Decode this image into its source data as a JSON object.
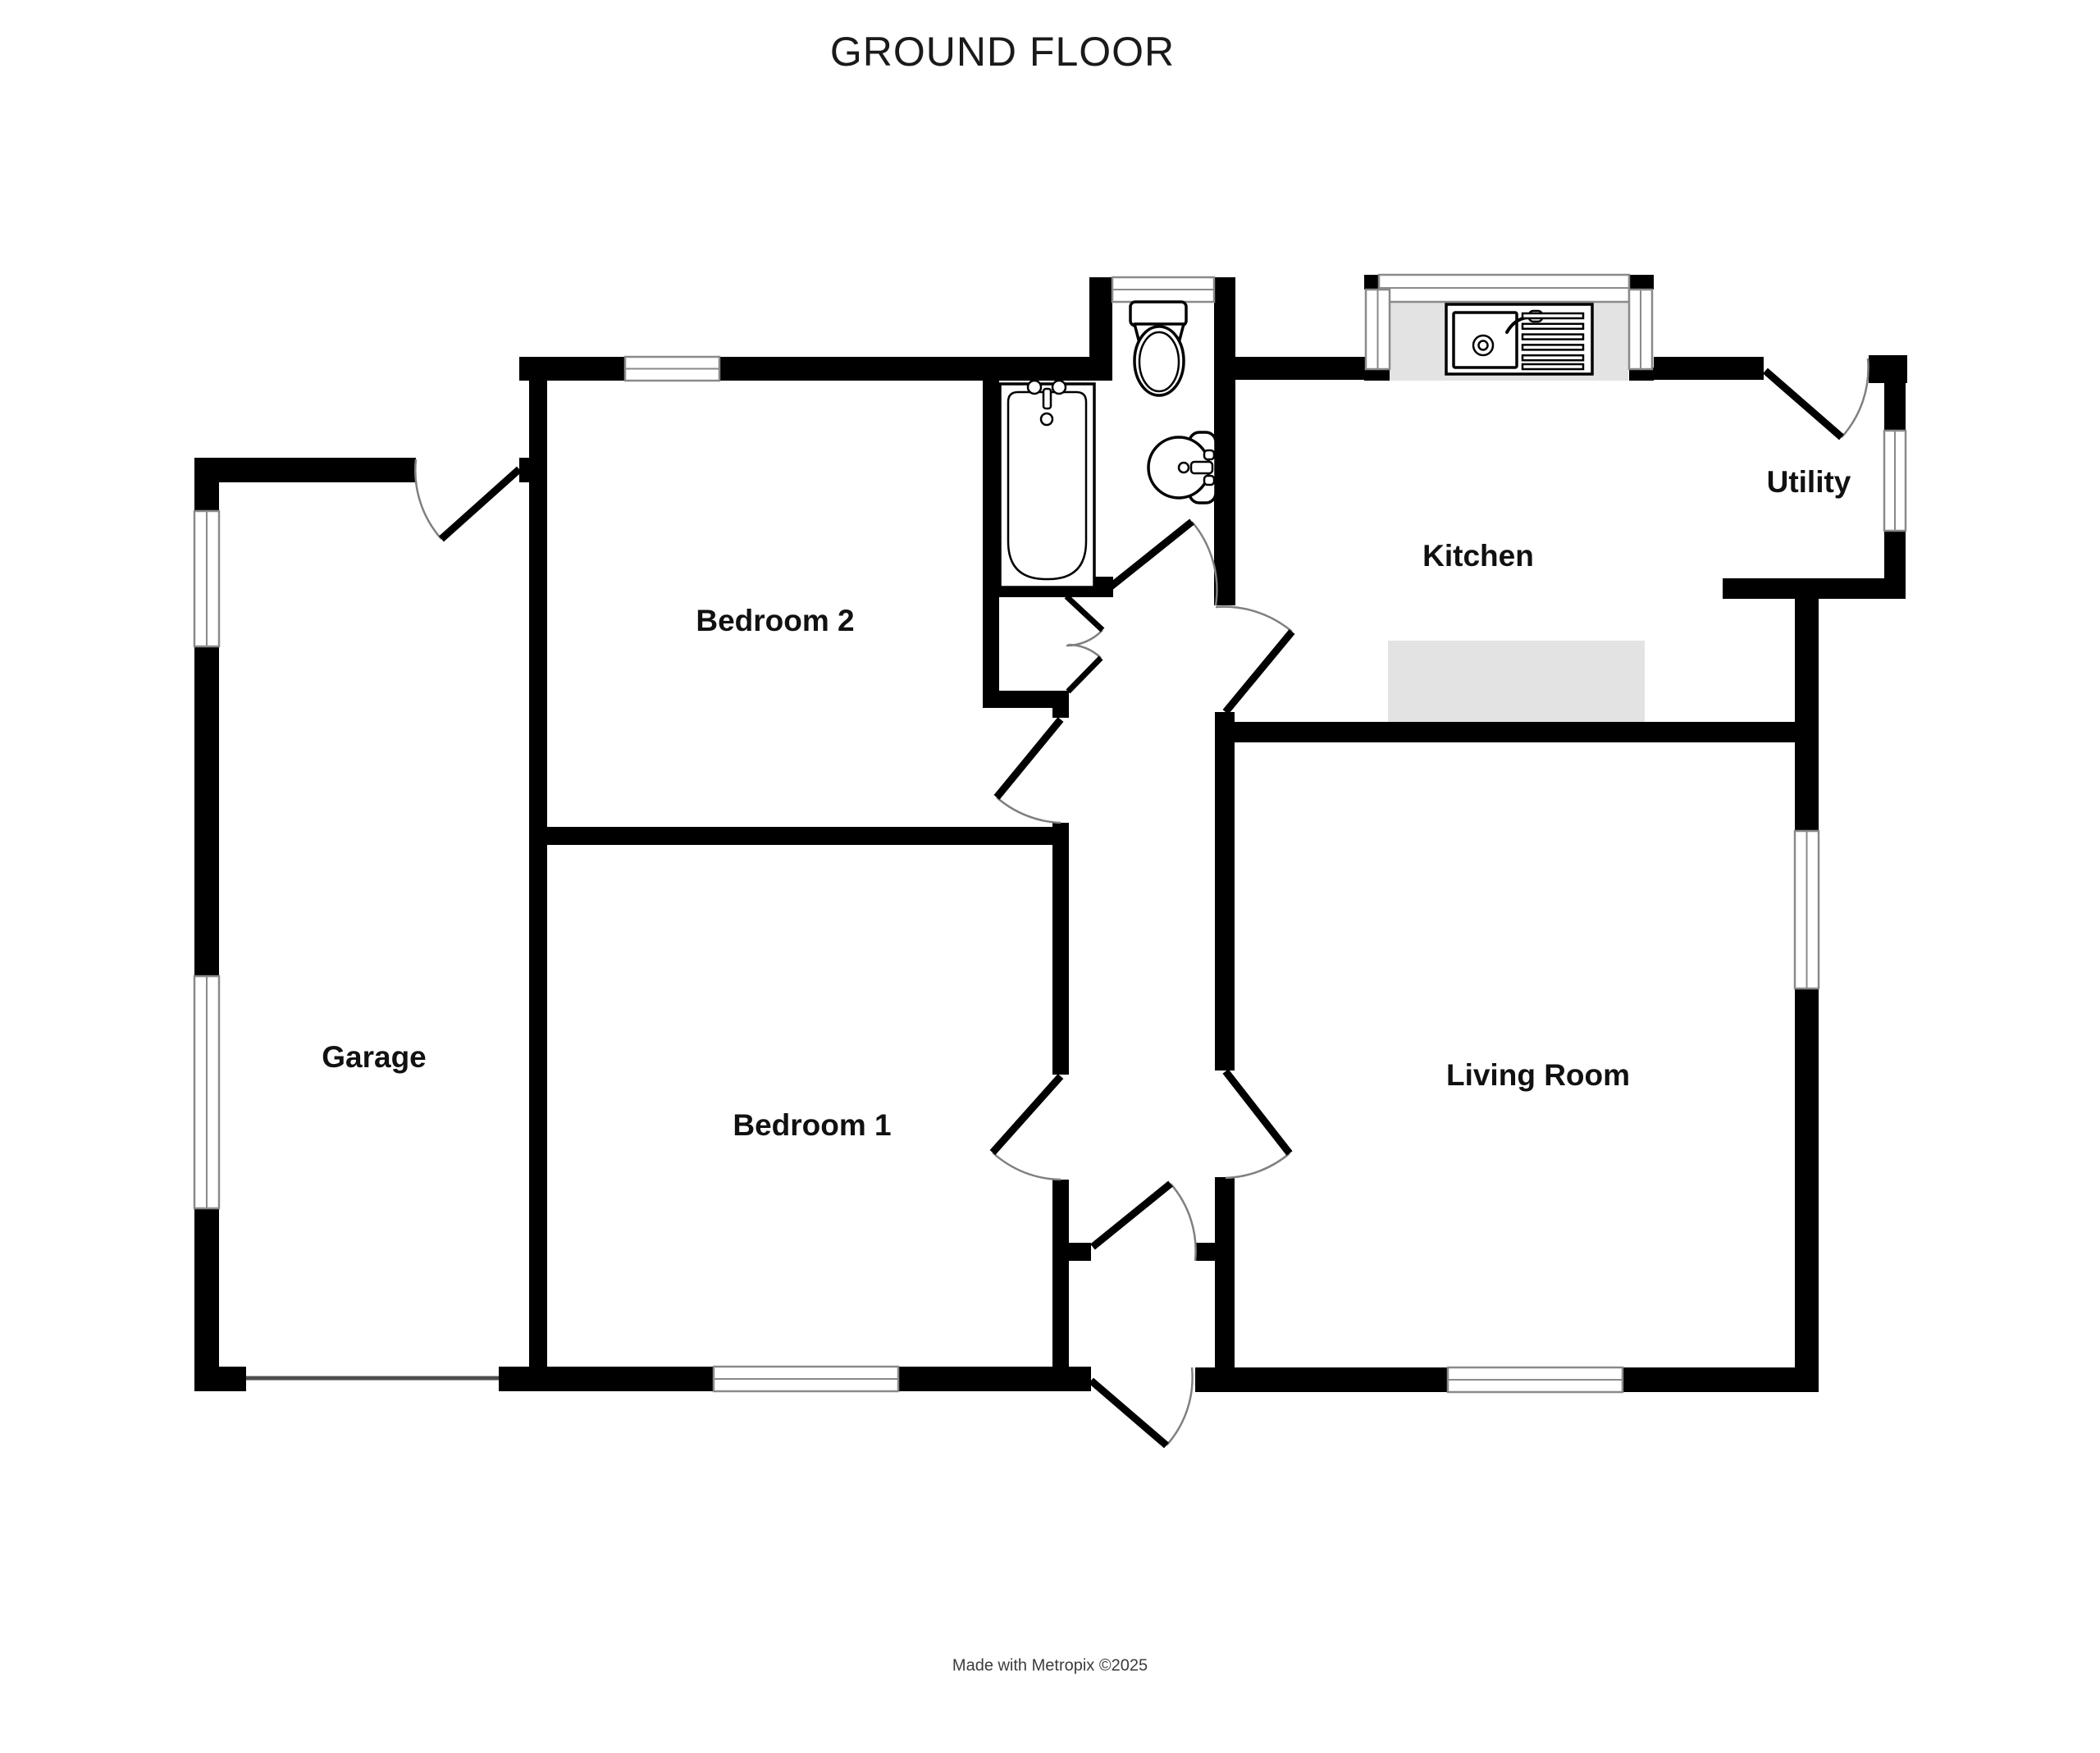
{
  "title": "GROUND FLOOR",
  "credit": "Made with Metropix ©2025",
  "rooms": {
    "garage": "Garage",
    "bedroom2": "Bedroom 2",
    "bedroom1": "Bedroom 1",
    "kitchen": "Kitchen",
    "utility": "Utility",
    "living_room": "Living Room"
  },
  "fixtures": [
    "bath",
    "toilet",
    "basin",
    "kitchen-sink",
    "worktop",
    "garage-door"
  ],
  "colors": {
    "wall": "#000000",
    "background": "#ffffff",
    "counter": "#e3e3e3",
    "window_frame": "#8a8a8a",
    "door_arc": "#808080"
  }
}
